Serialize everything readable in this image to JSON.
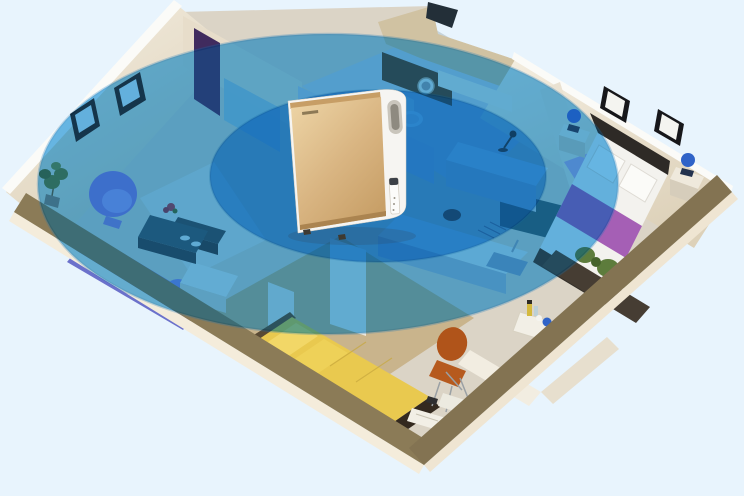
{
  "meta": {
    "alt": "3D isometric cutaway apartment; a gold and white air purifier stands in the living room center with two translucent blue ellipses showing clean-air coverage over the rooms",
    "legible_text": "none"
  },
  "scene": {
    "device": "air-purifier",
    "rooms": [
      "living-room",
      "bathroom",
      "kitchen",
      "master-bedroom",
      "second-bedroom",
      "study-corner",
      "entry-hall"
    ]
  },
  "coverage": {
    "rings": 2,
    "outer": {
      "cx": 328,
      "cy": 184,
      "rx": 290,
      "ry": 150
    },
    "inner": {
      "cx": 378,
      "cy": 176,
      "rx": 168,
      "ry": 86
    }
  },
  "colors": {
    "background": "#e8f4fd",
    "coverage_outer_tint": "#7cc2ec",
    "coverage_outer_fill": "#2f9bdc",
    "coverage_outer_edge": "#1273b8",
    "coverage_inner_tint": "#74b8e8",
    "coverage_inner_fill": "#2490d4",
    "coverage_inner_edge": "#11679f",
    "floor_light": "#dbd4c6",
    "floor_wood": "#c9b48c",
    "floor_bath": "#c6d3da",
    "rug_living": "#e4e1d7",
    "wall_cream_light": "#f4eee1",
    "wall_cream_shadow": "#ddd1b9",
    "wall_top_white": "#fbfbf8",
    "wall_cut_taupe": "#8b7b57",
    "wall_cut_taupe_dark": "#837352",
    "wall_outer_face": "#f4ecdb",
    "wall_tan": "#d0c2a2",
    "partition_blue": "#b6cad8",
    "glass_teal": "#8fc3d4",
    "closet_purple": "#402b5e",
    "sofa_purple": "#7b82d8",
    "sofa_purple_dark": "#6b71cb",
    "chair_purple": "#8a7ed6",
    "table_teal": "#2c5765",
    "tv_cabinet_teal": "#2a4a56",
    "cabinet_teal": "#23606e",
    "side_table_white": "#f0ece2",
    "bed_yellow": "#e9c94f",
    "pillow_yellow": "#f2d767",
    "bed_frame_dark": "#33291f",
    "bedding_white": "#f3f2ee",
    "headboard_dark": "#2e2a26",
    "runner_purple": "#a55fb5",
    "bedroom_rug_lavender": "#b3a7dc",
    "lamp_blue": "#2f63c8",
    "nightstand_cream": "#efe9dc",
    "chair_orange": "#b65a1e",
    "plant_green": "#5d7c3c",
    "planter_dark": "#463d33",
    "kitchen_counter": "#e0e6e3",
    "kitchen_counter_front": "#a9bcc8",
    "sink_blue": "#7fa3bc",
    "purifier_white": "#f6f5f2",
    "purifier_gold_light": "#ecd3a4",
    "purifier_gold": "#d9b582",
    "purifier_gold_dark": "#c59c63",
    "purifier_vent_gold": "#c79e66",
    "purifier_shadow": "#32465a"
  }
}
